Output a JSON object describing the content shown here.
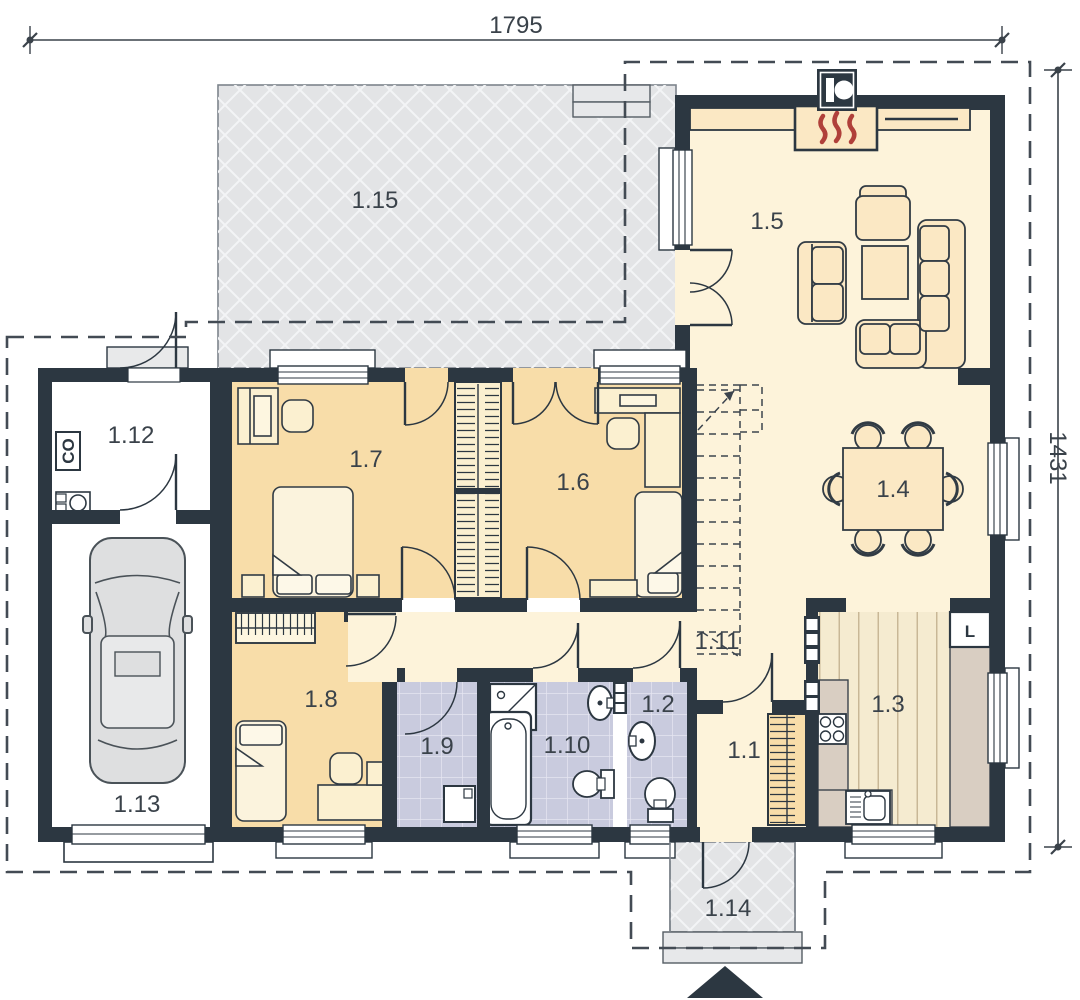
{
  "drawing_title": "ground-floor-plan",
  "dimensions": {
    "top": "1795",
    "right": "1431"
  },
  "room_labels": {
    "hall": "1.1",
    "wc": "1.2",
    "kitchen": "1.3",
    "dining": "1.4",
    "living": "1.5",
    "bedroom_right": "1.6",
    "bedroom_left": "1.7",
    "bedroom_small": "1.8",
    "laundry": "1.9",
    "bathroom": "1.10",
    "corridor": "1.11",
    "utility": "1.12",
    "garage": "1.13",
    "porch": "1.14",
    "terrace": "1.15"
  },
  "annotations": {
    "boiler": "CO",
    "fridge": "L"
  },
  "colors": {
    "wall": "#2c3741",
    "floor_main": "#fdf3da",
    "floor_bedroom": "#f8dda9",
    "floor_bath": "#c9cbde",
    "floor_terrace": "#e3e4e6",
    "counter": "#d9cec2",
    "furniture": "#fbe8c4",
    "flame": "#b0403a",
    "car": "#dedfe0"
  }
}
